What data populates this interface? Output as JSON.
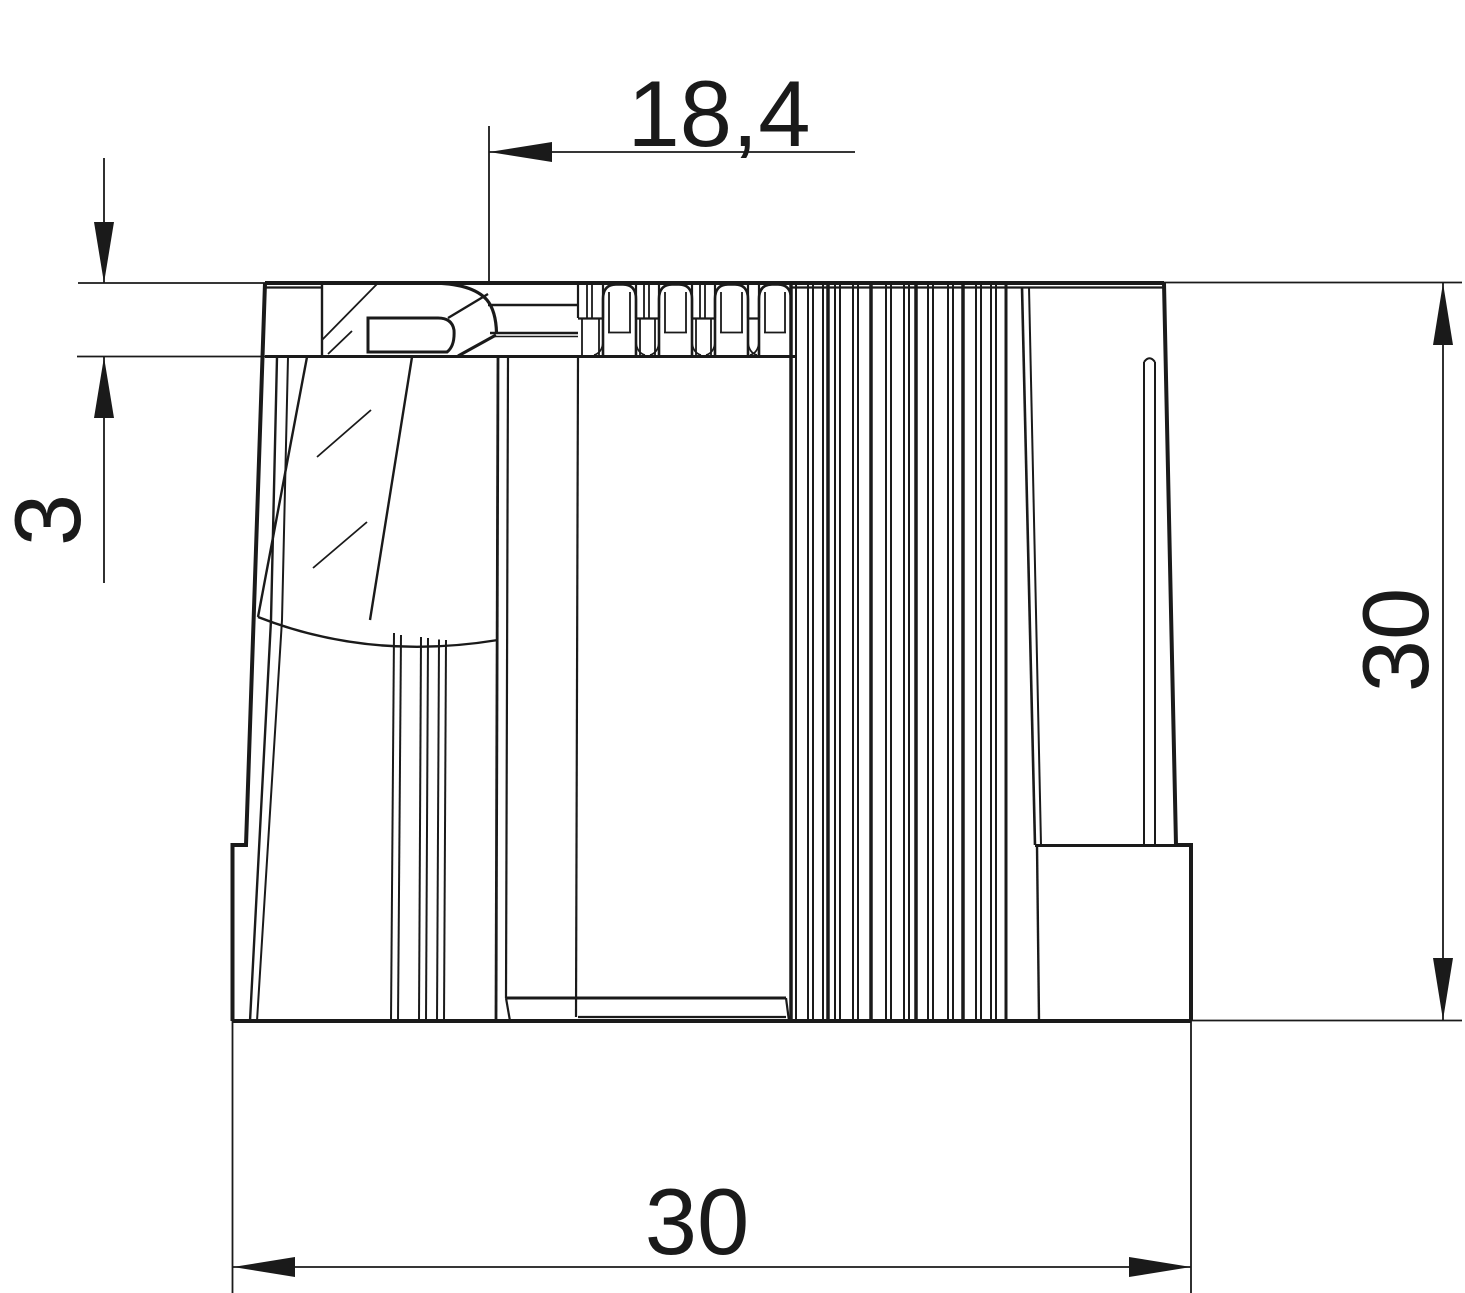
{
  "drawing": {
    "kind": "technical-dimension-drawing",
    "colors": {
      "line": "#1a1a1a",
      "background": "#ffffff"
    },
    "dimensions": {
      "top": {
        "label": "18,4"
      },
      "left": {
        "label": "3"
      },
      "right": {
        "label": "30"
      },
      "bottom": {
        "label": "30"
      }
    }
  }
}
